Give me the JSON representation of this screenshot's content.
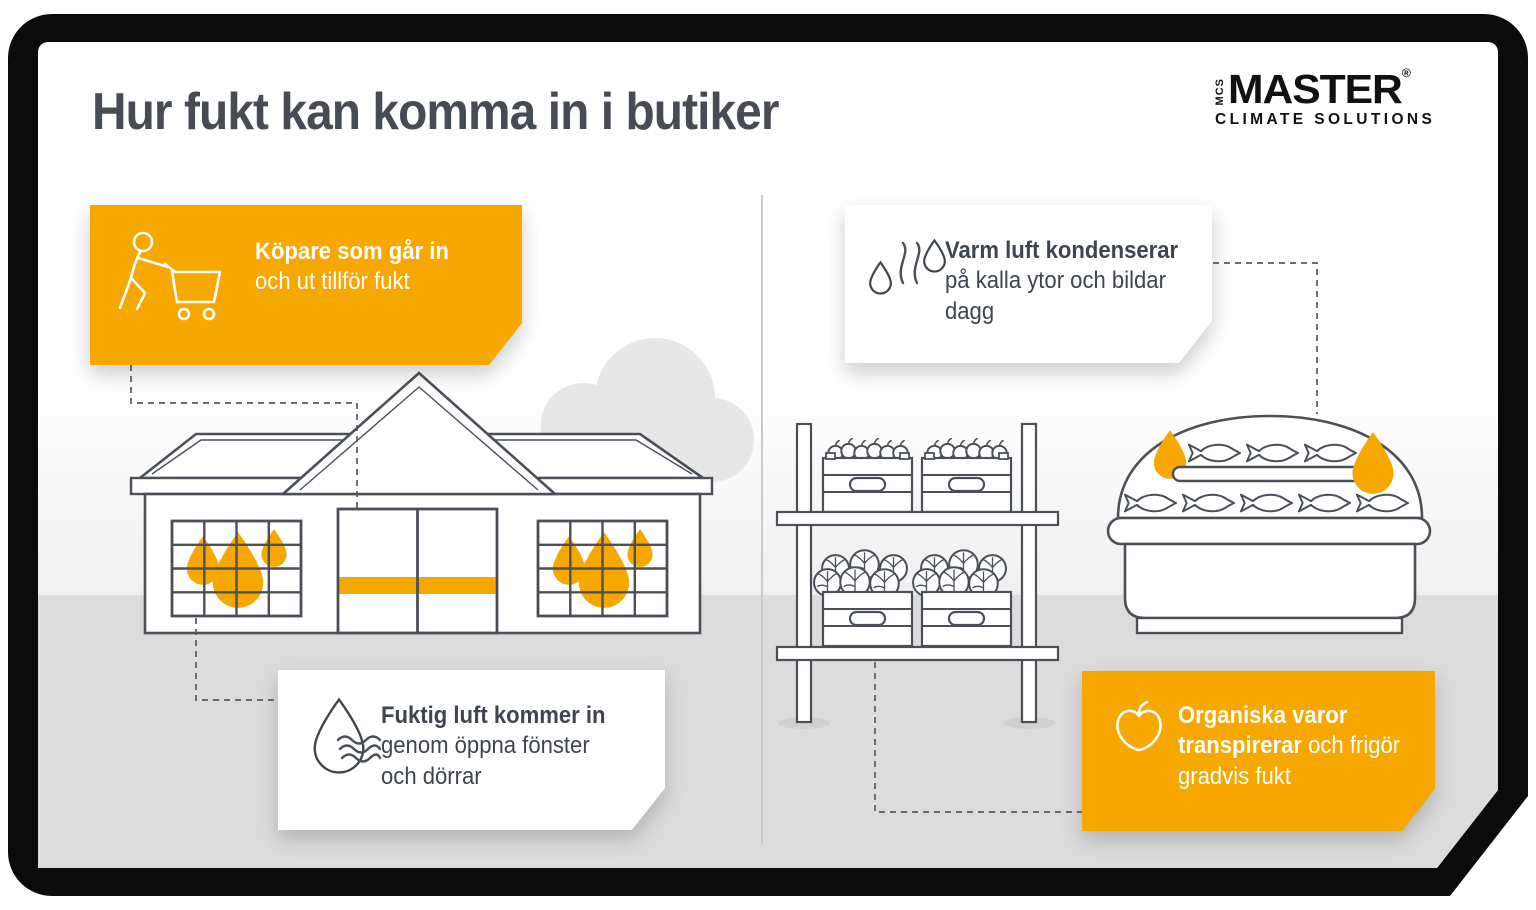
{
  "title": "Hur fukt kan komma in i butiker",
  "logo": {
    "mcs": "MCS",
    "master": "MASTER",
    "reg": "®",
    "subtitle": "CLIMATE SOLUTIONS"
  },
  "colors": {
    "accent_orange": "#F6A800",
    "outline_ink": "#4B5058",
    "text_dark": "#3F454E",
    "title_color": "#464B54",
    "floor_gray": "#DCDCDC",
    "frame_black": "#0B0B0B",
    "cloud_gray": "#E7E7E7"
  },
  "callouts": [
    {
      "id": "shoppers",
      "style": "orange",
      "icon": "shopping-cart-person-icon",
      "bold": "Köpare som går in",
      "rest": "och ut tillför fukt"
    },
    {
      "id": "condensation",
      "style": "white",
      "icon": "steam-drops-icon",
      "bold": "Varm luft kondenserar",
      "rest": "på kalla ytor och bildar dagg"
    },
    {
      "id": "humid-air",
      "style": "white",
      "icon": "water-drop-icon",
      "bold": "Fuktig luft kommer in",
      "rest": "genom öppna fönster och dörrar"
    },
    {
      "id": "organic",
      "style": "orange",
      "icon": "apple-icon",
      "bold": "Organiska varor transpirerar",
      "rest": "och frigör gradvis fukt"
    }
  ],
  "illustrations": [
    "store-building-with-moisture-drops-in-windows",
    "cloud",
    "produce-shelf-with-apple-and-cabbage-crates",
    "fish-display-case-with-condensation-drops"
  ]
}
